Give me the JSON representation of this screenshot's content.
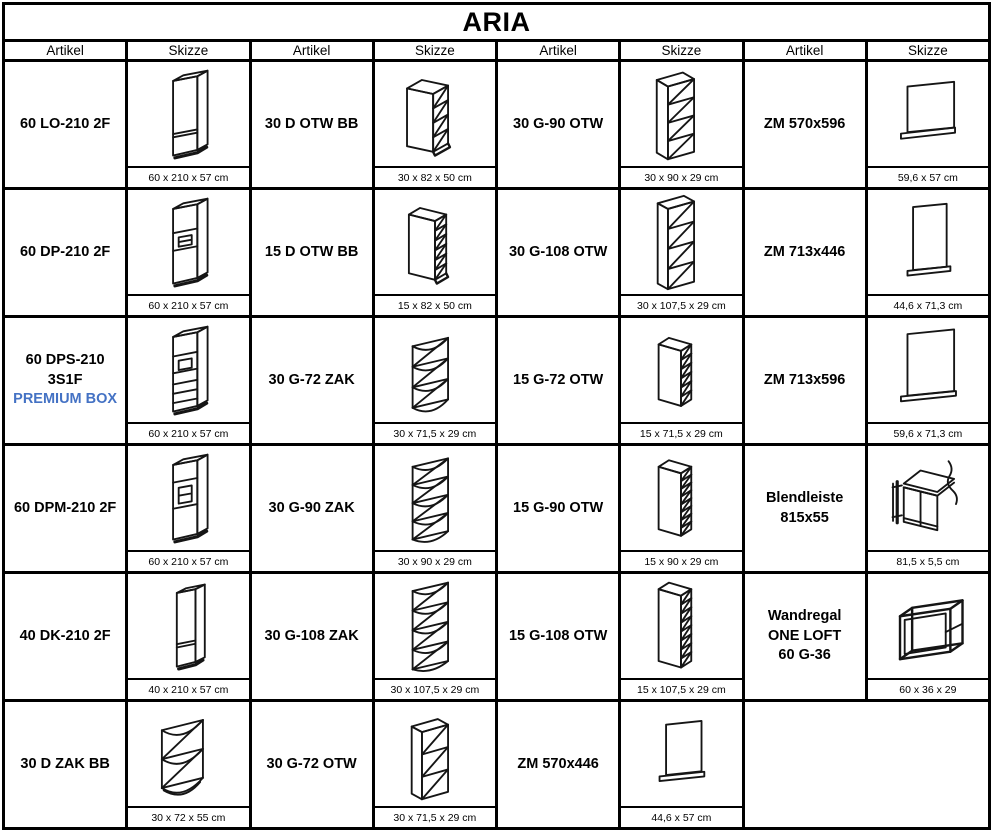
{
  "title": "ARIA",
  "columns": [
    "Artikel",
    "Skizze",
    "Artikel",
    "Skizze",
    "Artikel",
    "Skizze",
    "Artikel",
    "Skizze"
  ],
  "colors": {
    "title_bg": "#c8c8c8",
    "header_bg": "#dbdbdb",
    "border": "#000000",
    "premium_blue": "#4472C4"
  },
  "rows": [
    [
      {
        "art": "60 LO-210 2F",
        "dim": "60 x 210 x 57 cm",
        "sketch": "tall-cabinet-2-fronts"
      },
      {
        "art": "30 D OTW BB",
        "dim": "30 x 82 x 50 cm",
        "sketch": "open-shelf-base-cabinet"
      },
      {
        "art": "30 G-90 OTW",
        "dim": "30 x 90 x 29 cm",
        "sketch": "open-wall-cabinet-4-shelves"
      },
      {
        "art": "ZM 570x596",
        "dim": "59,6 x 57 cm",
        "sketch": "appliance-front-panel"
      }
    ],
    [
      {
        "art": "60 DP-210 2F",
        "dim": "60 x 210 x 57 cm",
        "sketch": "tall-oven-housing-cabinet"
      },
      {
        "art": "15 D OTW BB",
        "dim": "15 x 82 x 50 cm",
        "sketch": "narrow-open-shelf-base-cabinet"
      },
      {
        "art": "30 G-108 OTW",
        "dim": "30 x 107,5 x 29 cm",
        "sketch": "open-wall-cabinet-4-shelves-tall"
      },
      {
        "art": "ZM 713x446",
        "dim": "44,6 x 71,3 cm",
        "sketch": "appliance-front-panel-tall-narrow"
      }
    ],
    [
      {
        "art": "60 DPS-210 3S1F",
        "art2": "PREMIUM BOX",
        "dim": "60 x 210 x 57 cm",
        "sketch": "tall-oven-housing-with-drawers"
      },
      {
        "art": "30 G-72 ZAK",
        "dim": "30 x 71,5 x 29 cm",
        "sketch": "corner-open-wall-shelf-4"
      },
      {
        "art": "15 G-72 OTW",
        "dim": "15 x 71,5 x 29 cm",
        "sketch": "narrow-open-wall-cabinet"
      },
      {
        "art": "ZM 713x596",
        "dim": "59,6 x 71,3 cm",
        "sketch": "appliance-front-panel-tall"
      }
    ],
    [
      {
        "art": "60 DPM-210 2F",
        "dim": "60 x 210 x 57 cm",
        "sketch": "tall-microwave-housing-cabinet"
      },
      {
        "art": "30 G-90 ZAK",
        "dim": "30 x 90 x 29 cm",
        "sketch": "corner-open-wall-shelf-5"
      },
      {
        "art": "15 G-90 OTW",
        "dim": "15 x 90 x 29 cm",
        "sketch": "narrow-open-wall-cabinet-tall"
      },
      {
        "art": "Blendleiste",
        "art2": "815x55",
        "dim": "81,5 x 5,5 cm",
        "sketch": "filler-strip-on-base-cabinet"
      }
    ],
    [
      {
        "art": "40 DK-210 2F",
        "dim": "40 x 210 x 57 cm",
        "sketch": "tall-narrow-cabinet-2-fronts"
      },
      {
        "art": "30 G-108 ZAK",
        "dim": "30 x 107,5 x 29 cm",
        "sketch": "corner-open-wall-shelf-5-tall"
      },
      {
        "art": "15 G-108 OTW",
        "dim": "15 x 107,5 x 29 cm",
        "sketch": "narrow-open-wall-cabinet-tallest"
      },
      {
        "art": "Wandregal",
        "art2": "ONE LOFT",
        "art3": "60 G-36",
        "dim": "60 x 36 x 29",
        "sketch": "open-frame-wall-shelf"
      }
    ],
    [
      {
        "art": "30 D ZAK BB",
        "dim": "30 x 72 x 55 cm",
        "sketch": "corner-open-shelf-base-cabinet"
      },
      {
        "art": "30 G-72 OTW",
        "dim": "30 x 71,5 x 29 cm",
        "sketch": "open-wall-cabinet-3-shelves"
      },
      {
        "art": "ZM 570x446",
        "dim": "44,6 x 57 cm",
        "sketch": "appliance-front-panel-small"
      }
    ]
  ]
}
